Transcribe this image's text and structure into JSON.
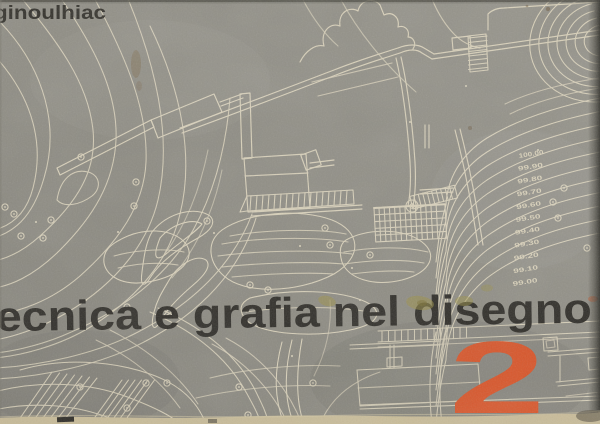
{
  "cover": {
    "author": "ginoulhiac",
    "title": "ecnica e grafia nel disegno",
    "volume_number": "2"
  },
  "plan": {
    "elevation_labels": [
      "100.00",
      "99.90",
      "99.80",
      "99.70",
      "99.60",
      "99.50",
      "99.40",
      "99.30",
      "99.20",
      "99.10",
      "99.00"
    ]
  },
  "colors": {
    "paper": "#8f8d84",
    "ink_lines": "#d9d1ba",
    "title_ink": "#2e2c27",
    "author_ink": "#33312b",
    "accent_orange": "#e2582a",
    "edge_right": "#3f3d36",
    "edge_bottom": "#c9bc98"
  }
}
